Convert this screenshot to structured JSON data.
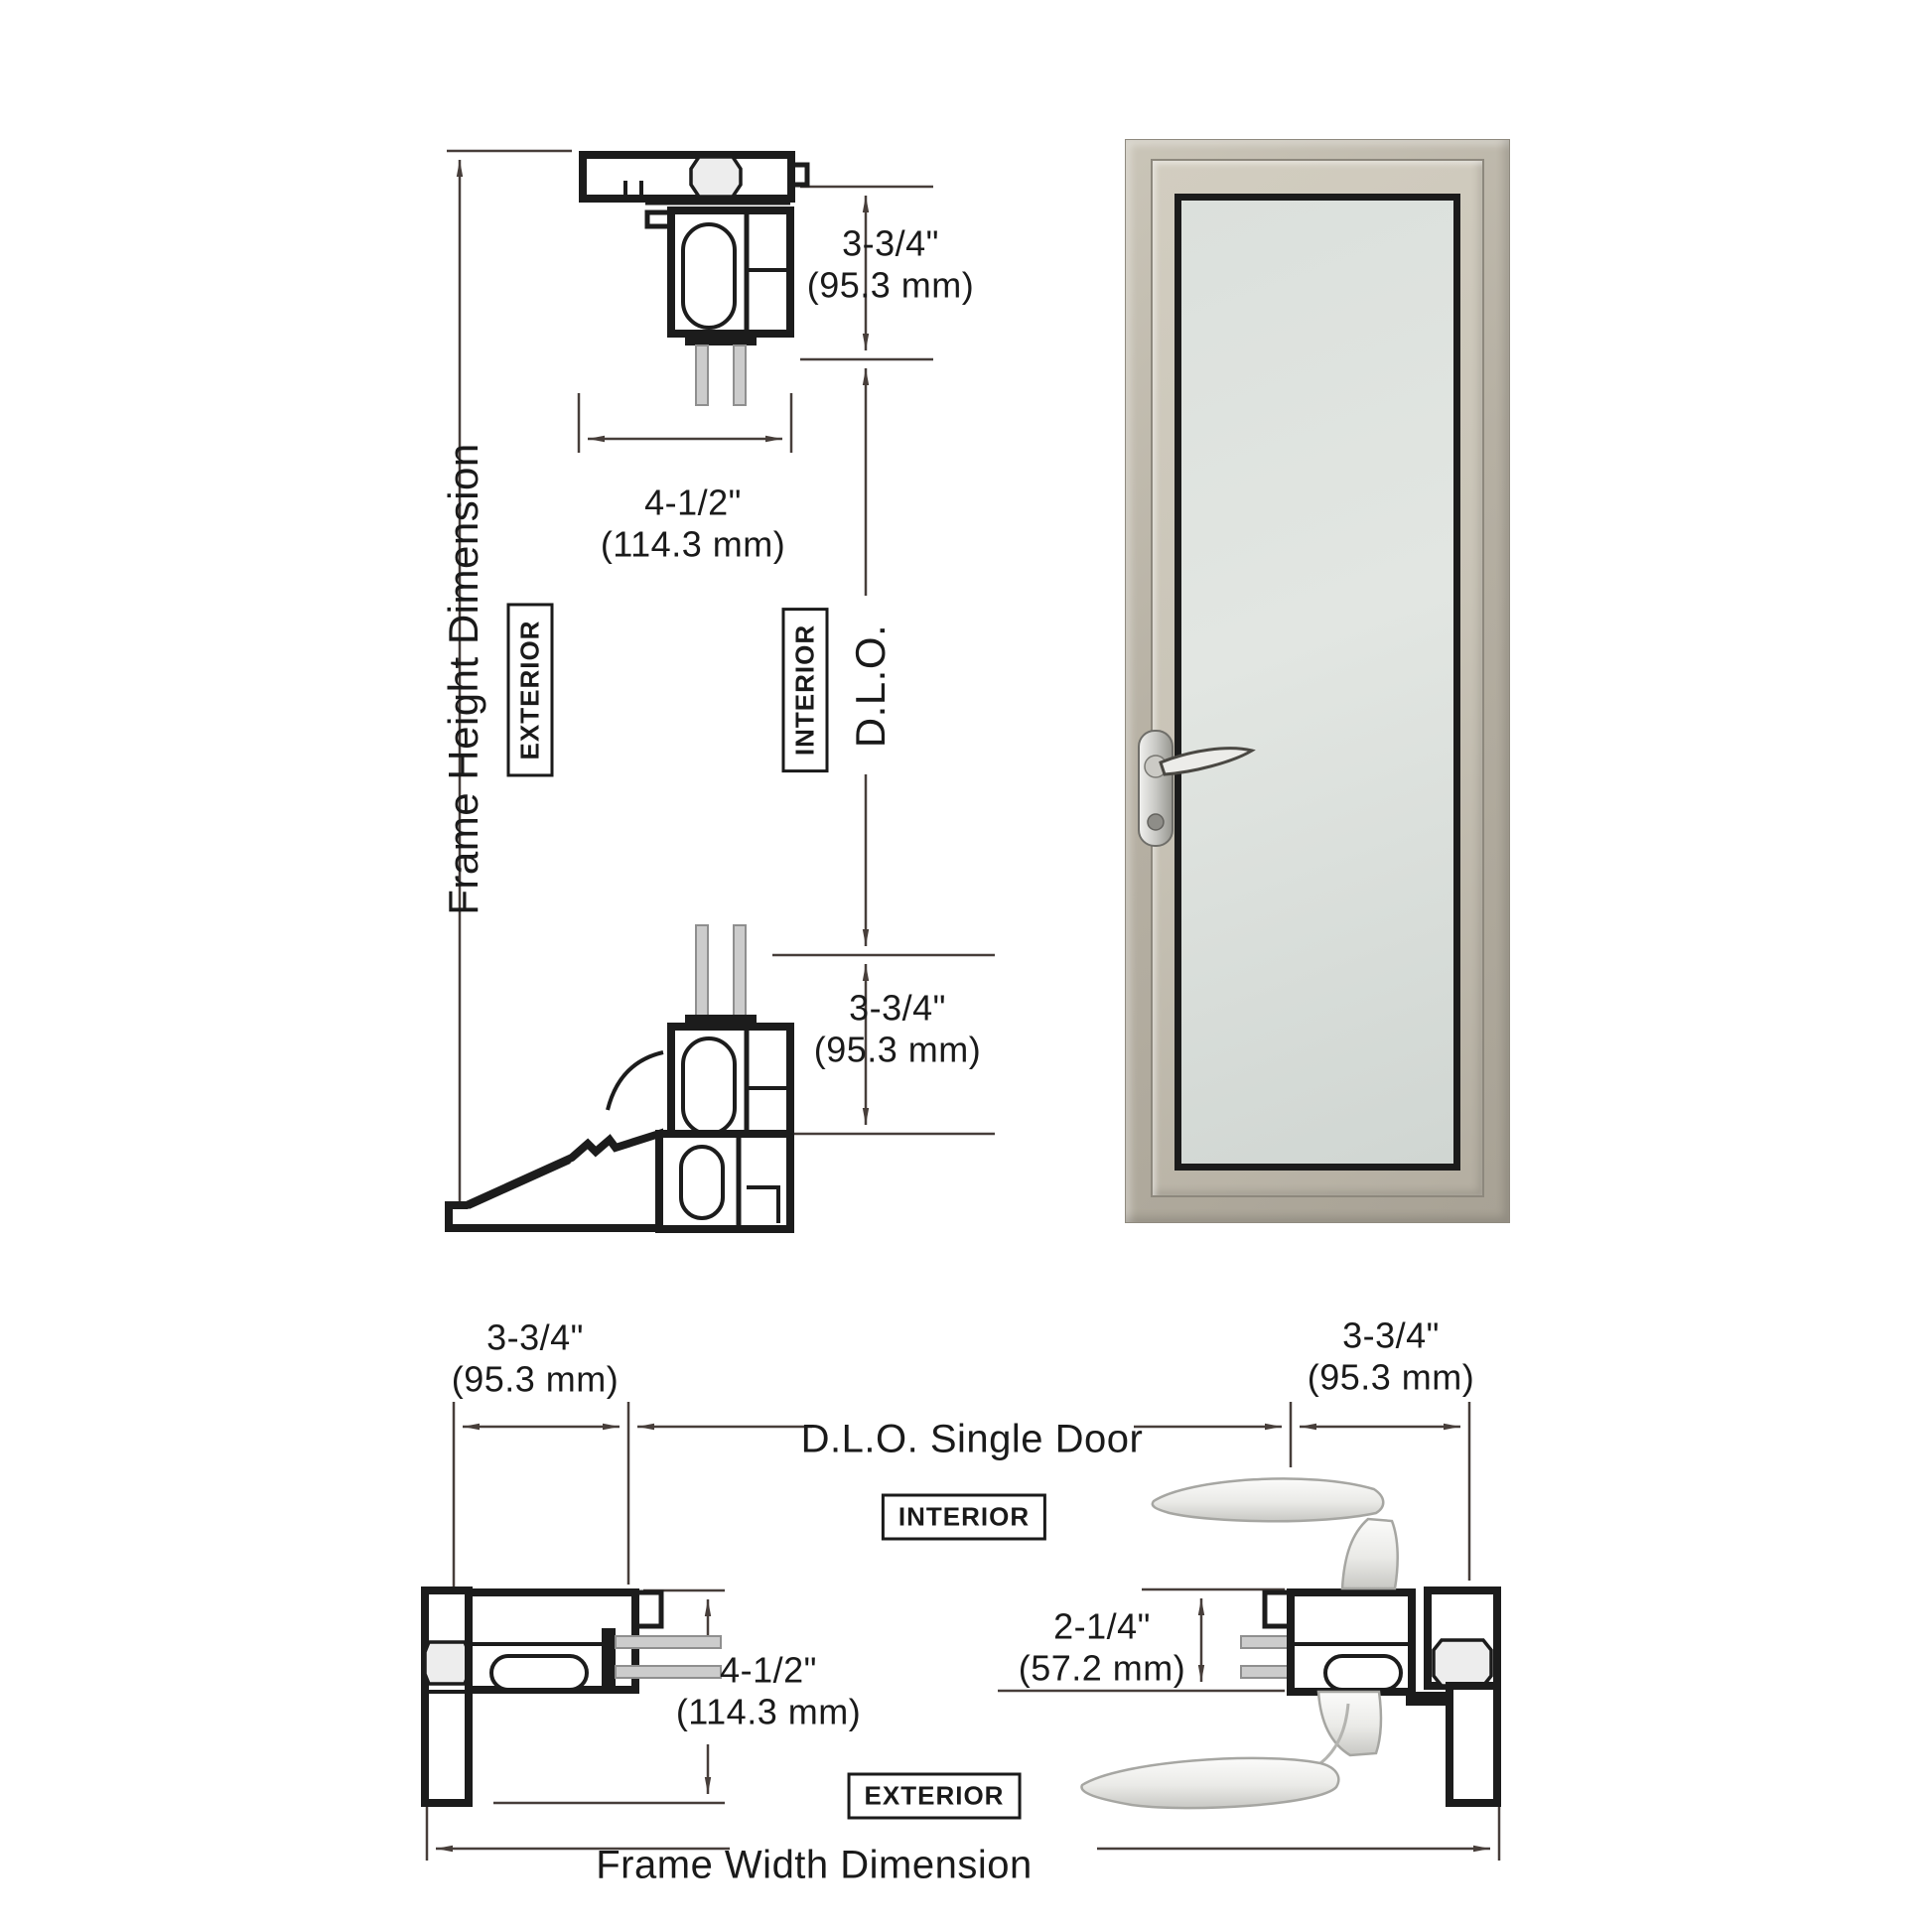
{
  "title": "Single door frame dimension diagram",
  "labels": {
    "frame_height": "Frame Height Dimension",
    "frame_width": "Frame Width Dimension",
    "dlo_vertical": "D.L.O.",
    "dlo_single_door": "D.L.O. Single Door",
    "exterior_section": "EXTERIOR",
    "interior_section": "INTERIOR",
    "interior_plan": "INTERIOR",
    "exterior_plan": "EXTERIOR"
  },
  "dims": {
    "head_height": {
      "in": "3-3/4\"",
      "mm": "(95.3 mm)"
    },
    "head_depth": {
      "in": "4-1/2\"",
      "mm": "(114.3 mm)"
    },
    "sill_height": {
      "in": "3-3/4\"",
      "mm": "(95.3 mm)"
    },
    "left_jamb": {
      "in": "3-3/4\"",
      "mm": "(95.3 mm)"
    },
    "right_jamb": {
      "in": "3-3/4\"",
      "mm": "(95.3 mm)"
    },
    "jamb_depth": {
      "in": "4-1/2\"",
      "mm": "(114.3 mm)"
    },
    "handle_backset": {
      "in": "2-1/4\"",
      "mm": "(57.2 mm)"
    }
  },
  "colors": {
    "background": "#ffffff",
    "line": "#1c1c1c",
    "dim": "#473e3a",
    "text": "#1a1a1a",
    "thermal_fill": "#ededed",
    "glass_bar": "#cccccc",
    "glass_bar_edge": "#8f8f8f",
    "door_frame": "#b6b0a3",
    "door_frame_dark": "#8f8a7f",
    "door_leaf": "#c9c4b7",
    "gasket": "#1b1b1b",
    "glass_a": "#dbe0dc",
    "glass_b": "#d0d6d2"
  }
}
